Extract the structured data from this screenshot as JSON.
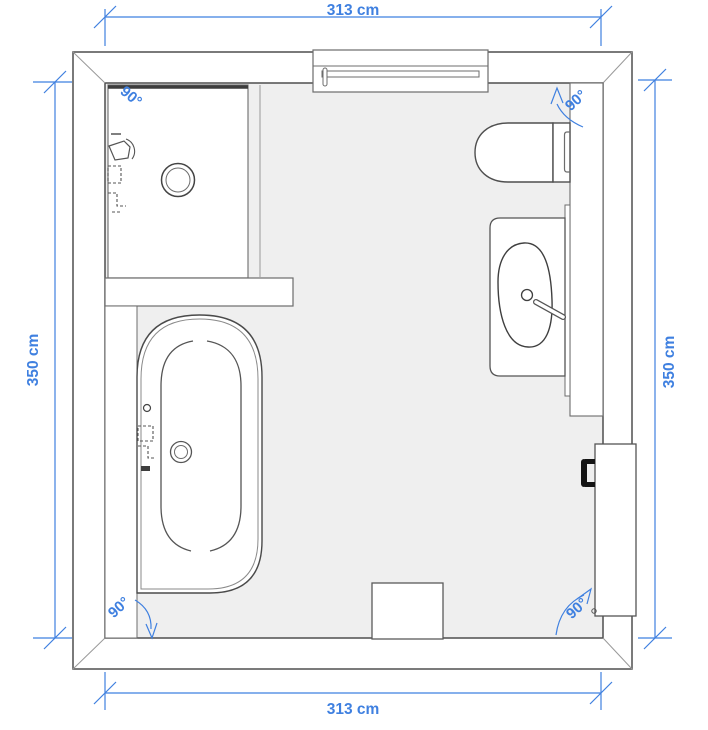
{
  "plan": {
    "type": "bathroom-floor-plan",
    "room": {
      "width_cm": 313,
      "height_cm": 350
    },
    "dimensions": {
      "top": "313 cm",
      "bottom": "313 cm",
      "left": "350 cm",
      "right": "350 cm"
    },
    "angles": {
      "top_left": "90°",
      "top_right": "90°",
      "bottom_left": "90°",
      "bottom_right": "90°"
    },
    "fixtures": [
      "shower",
      "shelf",
      "bathtub",
      "toilet",
      "washbasin-vanity",
      "wall-panel",
      "door",
      "window",
      "wall-block"
    ],
    "colors": {
      "dimension_blue": "#3f80e0",
      "floor_gray": "#efefef",
      "wall_outline": "#4f4f4f",
      "fixture_outline": "#555555",
      "door_handle": "#141414",
      "background": "#ffffff"
    }
  }
}
